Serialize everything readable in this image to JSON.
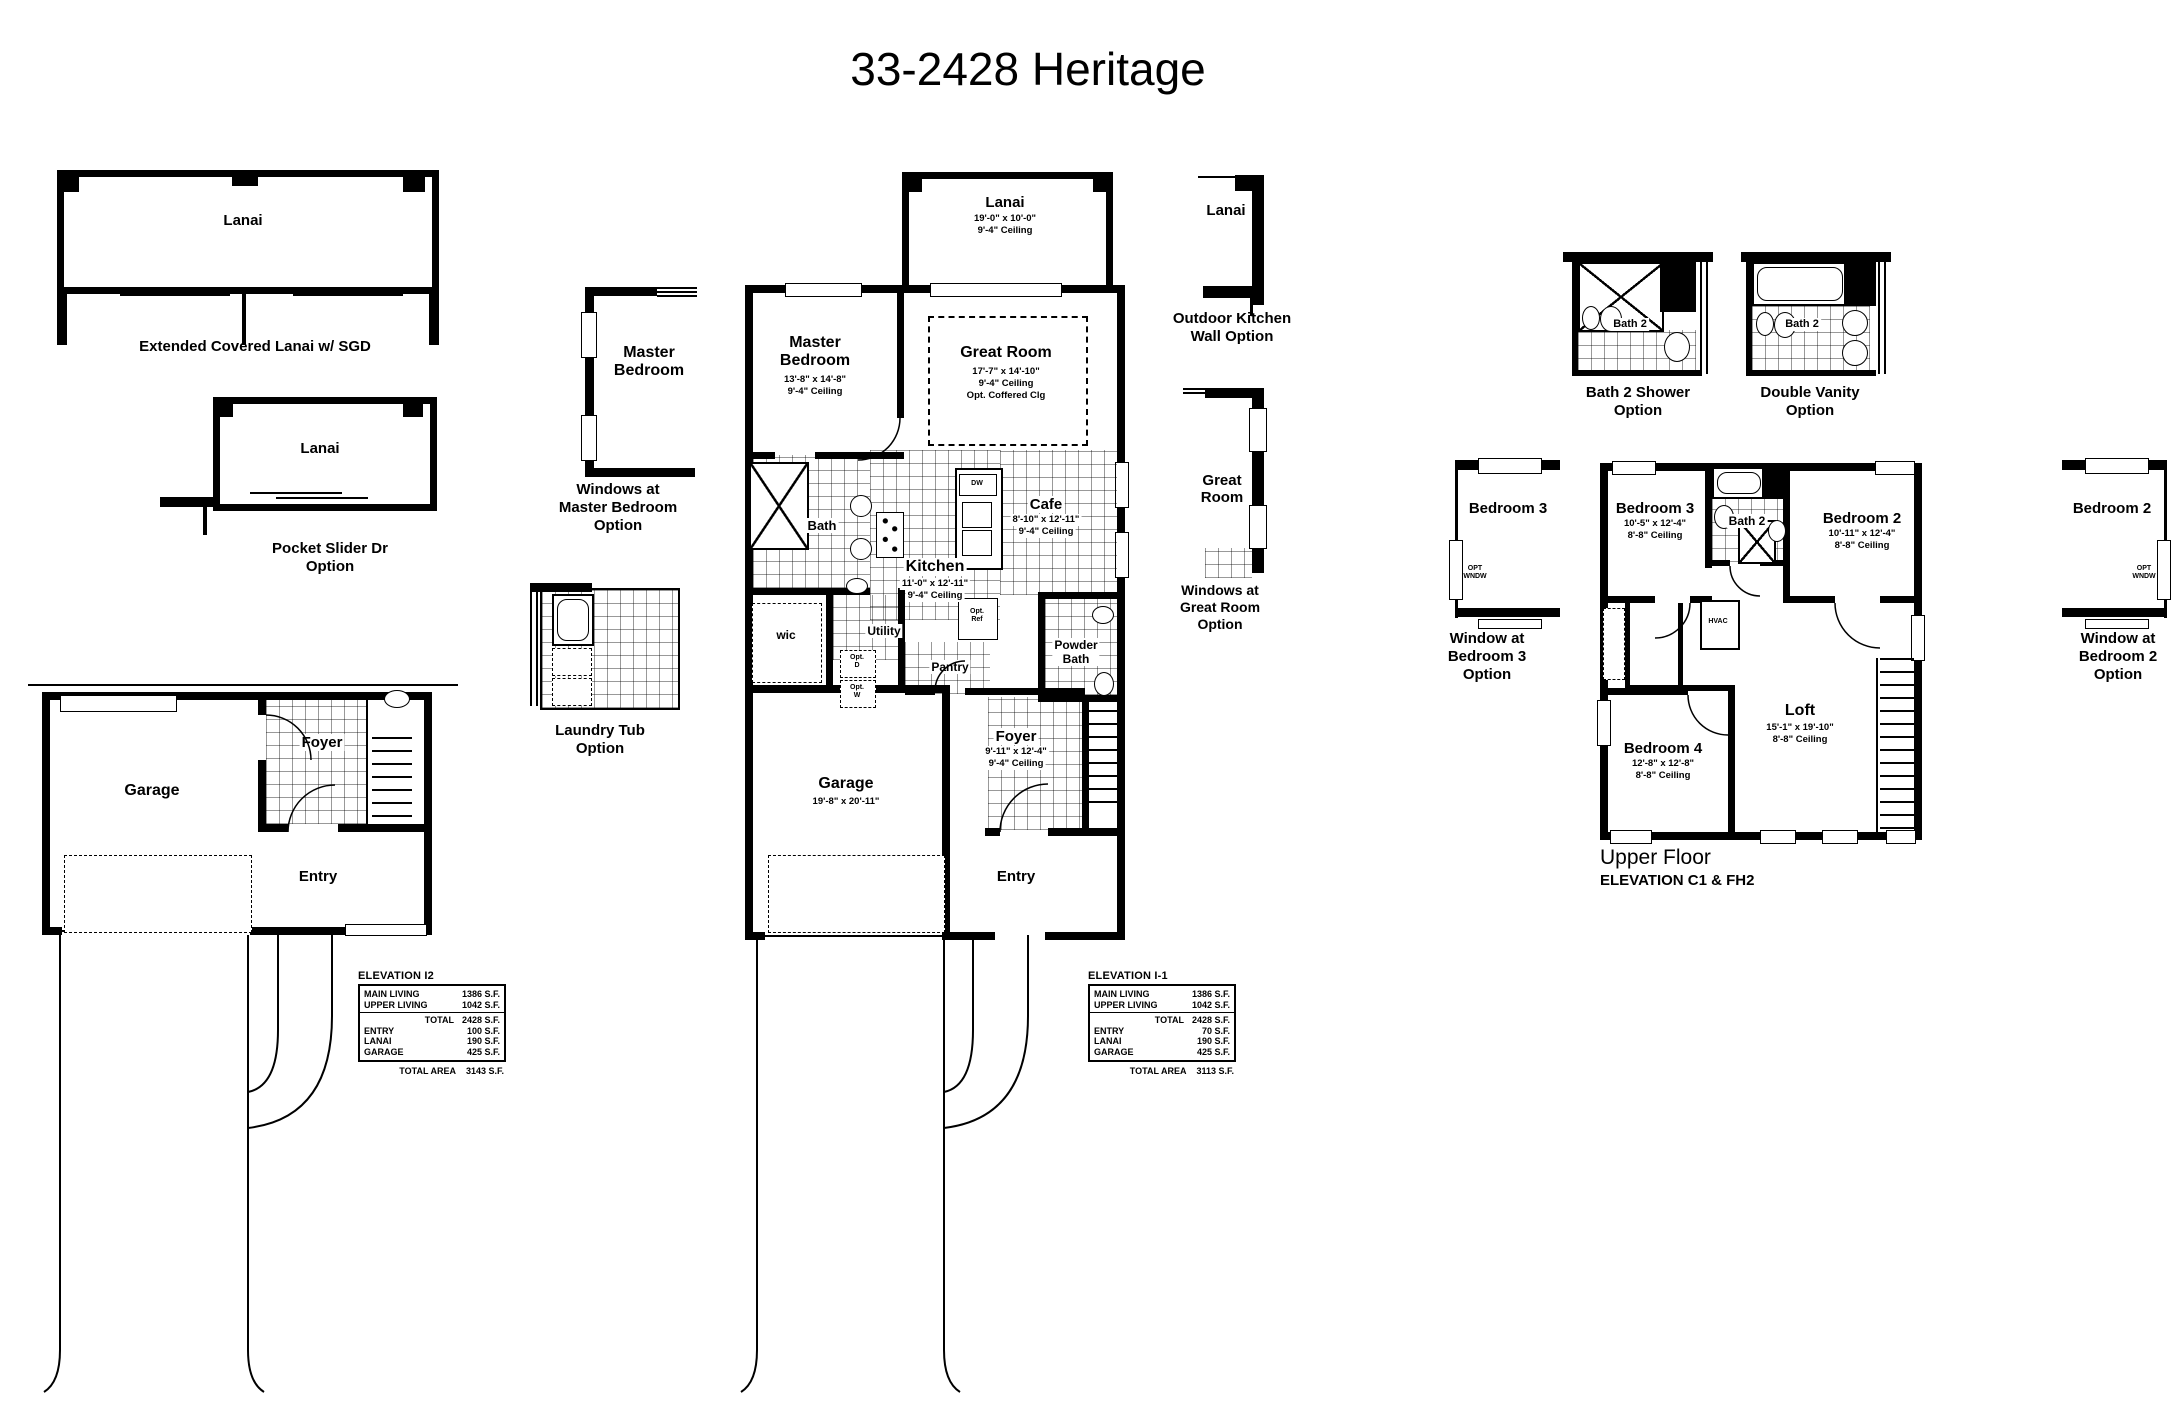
{
  "title": "33-2428 Heritage",
  "colors": {
    "ink": "#000000",
    "paper": "#ffffff"
  },
  "left_options": {
    "ext_lanai_room": "Lanai",
    "ext_lanai_caption": "Extended Covered Lanai w/ SGD",
    "pocket_room": "Lanai",
    "pocket_caption_1": "Pocket Slider Dr",
    "pocket_caption_2": "Option",
    "mbr_room_1": "Master",
    "mbr_room_2": "Bedroom",
    "mbr_caption_1": "Windows at",
    "mbr_caption_2": "Master Bedroom",
    "mbr_caption_3": "Option",
    "laundry_caption_1": "Laundry Tub",
    "laundry_caption_2": "Option"
  },
  "left_plan": {
    "garage": "Garage",
    "foyer": "Foyer",
    "entry": "Entry"
  },
  "main_plan": {
    "lanai_name": "Lanai",
    "lanai_dim": "19'-0\" x 10'-0\"",
    "lanai_ceil": "9'-4\" Ceiling",
    "master_1": "Master",
    "master_2": "Bedroom",
    "master_dim": "13'-8\" x 14'-8\"",
    "master_ceil": "9'-4\" Ceiling",
    "great_name": "Great Room",
    "great_dim": "17'-7\" x 14'-10\"",
    "great_ceil": "9'-4\" Ceiling",
    "great_opt": "Opt. Coffered Clg",
    "bath": "Bath",
    "cafe_name": "Cafe",
    "cafe_dim": "8'-10\" x 12'-11\"",
    "cafe_ceil": "9'-4\" Ceiling",
    "kitchen_name": "Kitchen",
    "kitchen_dim": "11'-0\" x 12'-11\"",
    "kitchen_ceil": "9'-4\" Ceiling",
    "wic": "wic",
    "utility": "Utility",
    "pantry": "Pantry",
    "powder_1": "Powder",
    "powder_2": "Bath",
    "foyer_name": "Foyer",
    "foyer_dim": "9'-11\" x 12'-4\"",
    "foyer_ceil": "9'-4\" Ceiling",
    "garage_name": "Garage",
    "garage_dim": "19'-8\" x 20'-11\"",
    "entry": "Entry",
    "dw": "DW",
    "opt_ref_1": "Opt.",
    "opt_ref_2": "Ref",
    "opt_d_1": "Opt.",
    "opt_d_2": "D",
    "opt_w_1": "Opt.",
    "opt_w_2": "W"
  },
  "right_options": {
    "lanai": "Lanai",
    "outdoor_caption_1": "Outdoor Kitchen",
    "outdoor_caption_2": "Wall Option",
    "great_1": "Great",
    "great_2": "Room",
    "windows_caption_1": "Windows at",
    "windows_caption_2": "Great Room",
    "windows_caption_3": "Option"
  },
  "tables": {
    "i2": {
      "header": "ELEVATION I2",
      "main_label": "MAIN LIVING",
      "main_value": "1386 S.F.",
      "upper_label": "UPPER LIVING",
      "upper_value": "1042 S.F.",
      "total_label": "TOTAL",
      "total_value": "2428 S.F.",
      "entry_label": "ENTRY",
      "entry_value": "100 S.F.",
      "lanai_label": "LANAI",
      "lanai_value": "190 S.F.",
      "garage_label": "GARAGE",
      "garage_value": "425 S.F.",
      "area_label": "TOTAL AREA",
      "area_value": "3143 S.F."
    },
    "i1": {
      "header": "ELEVATION I-1",
      "main_label": "MAIN LIVING",
      "main_value": "1386 S.F.",
      "upper_label": "UPPER LIVING",
      "upper_value": "1042 S.F.",
      "total_label": "TOTAL",
      "total_value": "2428 S.F.",
      "entry_label": "ENTRY",
      "entry_value": "70 S.F.",
      "lanai_label": "LANAI",
      "lanai_value": "190 S.F.",
      "garage_label": "GARAGE",
      "garage_value": "425 S.F.",
      "area_label": "TOTAL AREA",
      "area_value": "3113 S.F."
    }
  },
  "upper": {
    "shower_room": "Bath 2",
    "shower_caption_1": "Bath 2 Shower",
    "shower_caption_2": "Option",
    "vanity_room": "Bath 2",
    "vanity_caption_1": "Double Vanity",
    "vanity_caption_2": "Option",
    "bed3opt_room": "Bedroom 3",
    "bed3opt_caption_1": "Window at",
    "bed3opt_caption_2": "Bedroom 3",
    "bed3opt_caption_3": "Option",
    "bed2opt_room": "Bedroom 2",
    "bed2opt_caption_1": "Window at",
    "bed2opt_caption_2": "Bedroom 2",
    "bed2opt_caption_3": "Option",
    "opt_wndw_1": "OPT",
    "opt_wndw_2": "WNDW",
    "bed3_name": "Bedroom 3",
    "bed3_dim": "10'-5\" x 12'-4\"",
    "bed3_ceil": "8'-8\" Ceiling",
    "bath2": "Bath 2",
    "bed2_name": "Bedroom 2",
    "bed2_dim": "10'-11\" x 12'-4\"",
    "bed2_ceil": "8'-8\" Ceiling",
    "loft_name": "Loft",
    "loft_dim": "15'-1\" x 19'-10\"",
    "loft_ceil": "8'-8\" Ceiling",
    "bed4_name": "Bedroom 4",
    "bed4_dim": "12'-8\" x 12'-8\"",
    "bed4_ceil": "8'-8\" Ceiling",
    "hvac": "HVAC",
    "floor_caption_1": "Upper Floor",
    "floor_caption_2": "ELEVATION C1 & FH2"
  }
}
